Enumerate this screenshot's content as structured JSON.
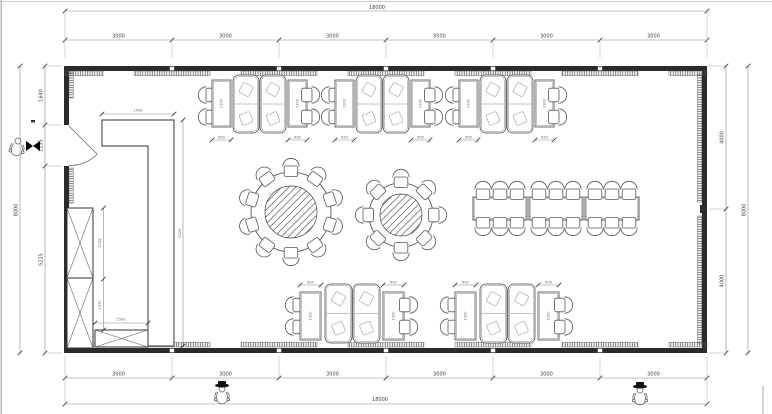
{
  "drawing": {
    "type": "architectural floor plan — restaurant dining hall",
    "units": "mm"
  },
  "dims": {
    "top": {
      "overall": "18000",
      "segments": [
        "3000",
        "3000",
        "3000",
        "3000",
        "3000",
        "3000"
      ]
    },
    "bottom": {
      "overall": "18000",
      "segments": [
        "3000",
        "3000",
        "3000",
        "3000",
        "3000",
        "3000"
      ]
    },
    "left": {
      "overall": "8000",
      "segments": [
        "1640",
        "1135",
        "5225"
      ]
    },
    "right": {
      "overall": "8000",
      "segments": [
        "4000",
        "4000"
      ]
    },
    "counter": {
      "width": "1500",
      "height": "6325"
    },
    "cabinets": {
      "upper": "2125",
      "lower": "1370",
      "base_width": "1500"
    },
    "booth_table": {
      "width": "650",
      "depth": "1300"
    }
  },
  "furniture": {
    "top_booth_groups": 3,
    "bottom_booth_groups": 2,
    "round_tables": [
      {
        "seats": 10
      },
      {
        "seats": 8
      }
    ],
    "banquet_tables": {
      "count": 3,
      "chairs_each": 6
    },
    "person_figures": 3
  }
}
